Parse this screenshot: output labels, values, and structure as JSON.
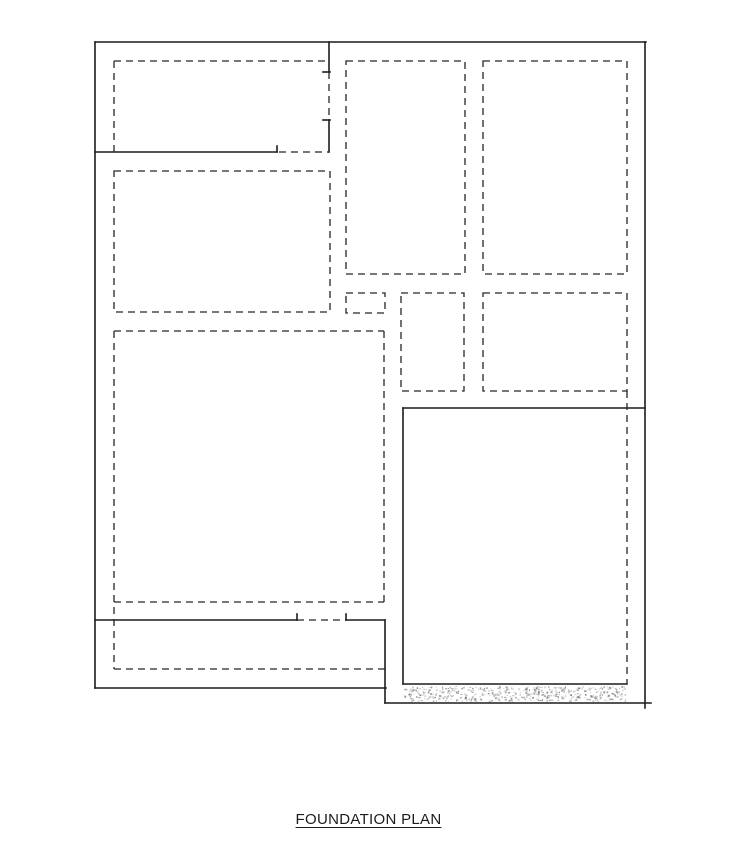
{
  "page": {
    "background": "#ffffff"
  },
  "title": {
    "text": "FOUNDATION PLAN"
  },
  "drawing": {
    "line_color": "#1c1c1c",
    "dash_color": "#262626",
    "dash_pattern": "7 5",
    "solid_width": 1.6,
    "dash_width": 1.3,
    "solid_lines": [
      [
        95,
        42,
        646,
        42
      ],
      [
        95,
        42,
        95,
        688
      ],
      [
        645,
        42,
        645,
        708
      ],
      [
        95,
        688,
        386,
        688
      ],
      [
        385,
        620,
        385,
        703
      ],
      [
        385,
        703,
        651,
        703
      ],
      [
        95,
        152,
        277,
        152
      ],
      [
        277,
        146,
        277,
        152
      ],
      [
        329,
        42,
        329,
        72
      ],
      [
        323,
        72,
        330,
        72
      ],
      [
        323,
        120,
        330,
        120
      ],
      [
        329,
        120,
        329,
        152
      ],
      [
        95,
        620,
        297,
        620
      ],
      [
        297,
        614,
        297,
        620
      ],
      [
        346,
        614,
        346,
        620
      ],
      [
        346,
        620,
        385,
        620
      ],
      [
        403,
        408,
        645,
        408
      ],
      [
        403,
        408,
        403,
        684
      ],
      [
        403,
        684,
        627,
        684
      ]
    ],
    "dashed_lines": [
      [
        279,
        152,
        329,
        152
      ],
      [
        329,
        72,
        329,
        120
      ],
      [
        297,
        620,
        346,
        620
      ],
      [
        114,
        61,
        325,
        61
      ],
      [
        114,
        61,
        114,
        152
      ],
      [
        114,
        331,
        114,
        669
      ],
      [
        114,
        331,
        384,
        331
      ],
      [
        384,
        331,
        384,
        602
      ],
      [
        114,
        602,
        384,
        602
      ],
      [
        114,
        669,
        385,
        669
      ],
      [
        627,
        391,
        627,
        684
      ]
    ],
    "dashed_rects": [
      [
        114,
        171,
        216,
        141
      ],
      [
        346,
        61,
        119,
        213
      ],
      [
        483,
        61,
        144,
        213
      ],
      [
        346,
        293,
        39,
        20
      ],
      [
        401,
        293,
        63,
        98
      ],
      [
        483,
        293,
        144,
        98
      ]
    ],
    "stipple_band": {
      "x": 404,
      "y": 686,
      "w": 223,
      "h": 16
    },
    "stipple_colors": [
      "#8f8f8f",
      "#a6a6a6",
      "#7a7a7a",
      "#bdbdbd",
      "#989898"
    ],
    "stipple_dot_count": 520
  }
}
